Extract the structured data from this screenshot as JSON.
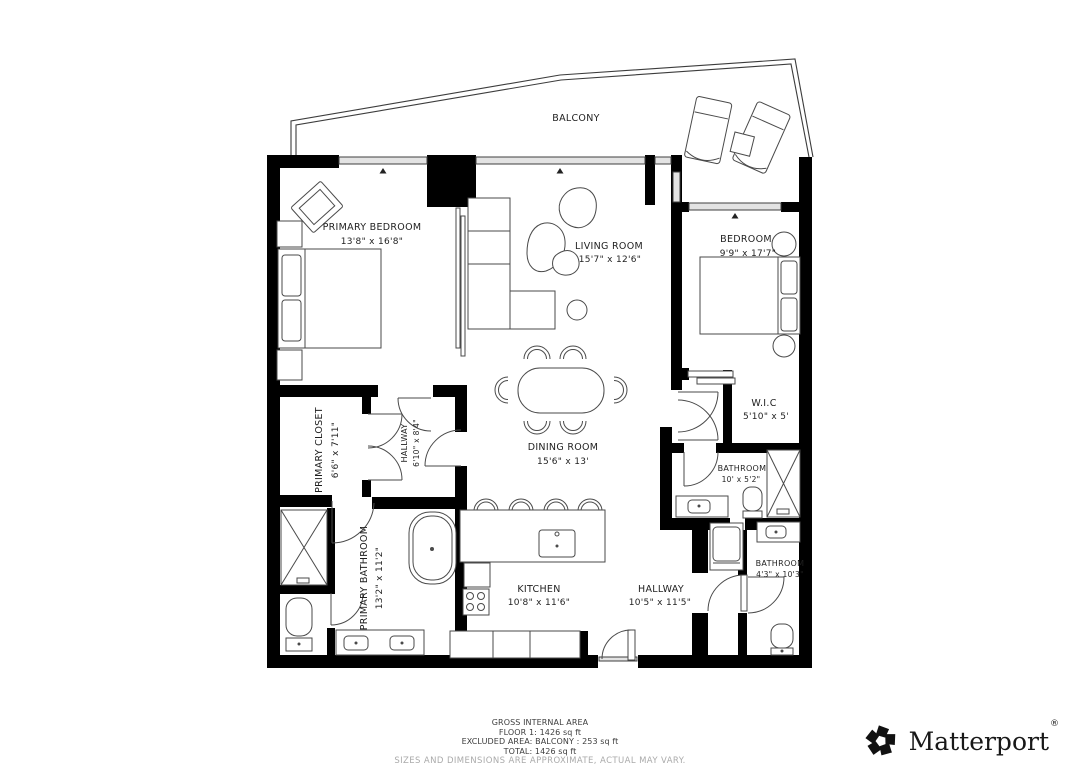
{
  "plan": {
    "balcony": {
      "label": "BALCONY"
    },
    "rooms": [
      {
        "id": "primary-bedroom",
        "label": "PRIMARY BEDROOM",
        "dims": "13'8\" x 16'8\""
      },
      {
        "id": "living-room",
        "label": "LIVING ROOM",
        "dims": "15'7\" x 12'6\""
      },
      {
        "id": "bedroom",
        "label": "BEDROOM",
        "dims": "9'9\" x 17'7\""
      },
      {
        "id": "primary-closet",
        "label": "PRIMARY CLOSET",
        "dims": "6'6\" x 7'11\""
      },
      {
        "id": "hallway-primary",
        "label": "HALLWAY",
        "dims": "6'10\" x 8'4\""
      },
      {
        "id": "wic",
        "label": "W.I.C",
        "dims": "5'10\" x 5'"
      },
      {
        "id": "dining-room",
        "label": "DINING ROOM",
        "dims": "15'6\" x 13'"
      },
      {
        "id": "bathroom-upper",
        "label": "BATHROOM",
        "dims": "10' x 5'2\""
      },
      {
        "id": "primary-bathroom",
        "label": "PRIMARY BATHROOM",
        "dims": "13'2\" x 11'2\""
      },
      {
        "id": "kitchen",
        "label": "KITCHEN",
        "dims": "10'8\" x 11'6\""
      },
      {
        "id": "hallway-main",
        "label": "HALLWAY",
        "dims": "10'5\" x 11'5\""
      },
      {
        "id": "bathroom-lower",
        "label": "BATHROOM",
        "dims": "4'3\" x 10'3\""
      }
    ]
  },
  "summary": {
    "line1": "GROSS INTERNAL AREA",
    "line2": "FLOOR 1: 1426 sq ft",
    "line3": "EXCLUDED AREA: BALCONY : 253 sq ft",
    "line4": "TOTAL: 1426 sq ft",
    "disclaimer": "SIZES AND DIMENSIONS ARE APPROXIMATE, ACTUAL MAY VARY."
  },
  "branding": {
    "logo_text": "Matterport",
    "registered_mark": "®"
  },
  "colors": {
    "wall": "#000000",
    "line": "#4a4a4a",
    "text": "#1f1f1f",
    "muted": "#aaaaaa"
  }
}
